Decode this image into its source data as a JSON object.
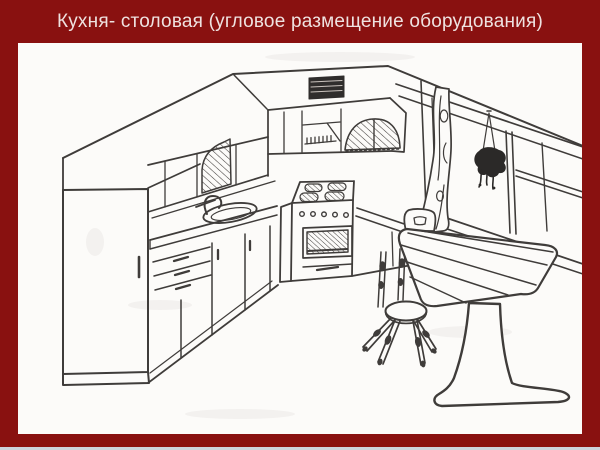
{
  "slide": {
    "title": "Кухня- столовая (угловое размещение оборудования)",
    "colors": {
      "background": "#891110",
      "panel": "#FCFBF9",
      "title_text": "#EFE2E0",
      "line": "#3F3C3A",
      "grille": "#2F2D2C",
      "plant": "#2B2928",
      "footer_strip": "#CCD3DD"
    },
    "illustration": {
      "type": "perspective line drawing of a corner kitchen",
      "elements": [
        "tall-cabinet",
        "left-wall-cabinets",
        "arched-glass-door-left",
        "back-wall-cabinets",
        "arched-glass-door-back",
        "ventilation-grille",
        "hood-niche",
        "countertop",
        "sink",
        "faucet",
        "base-cabinets-drawers",
        "stove-with-oven",
        "right-counter",
        "window",
        "curtain",
        "hanging-plant",
        "chair",
        "pedestal-dining-table",
        "stool"
      ]
    }
  }
}
